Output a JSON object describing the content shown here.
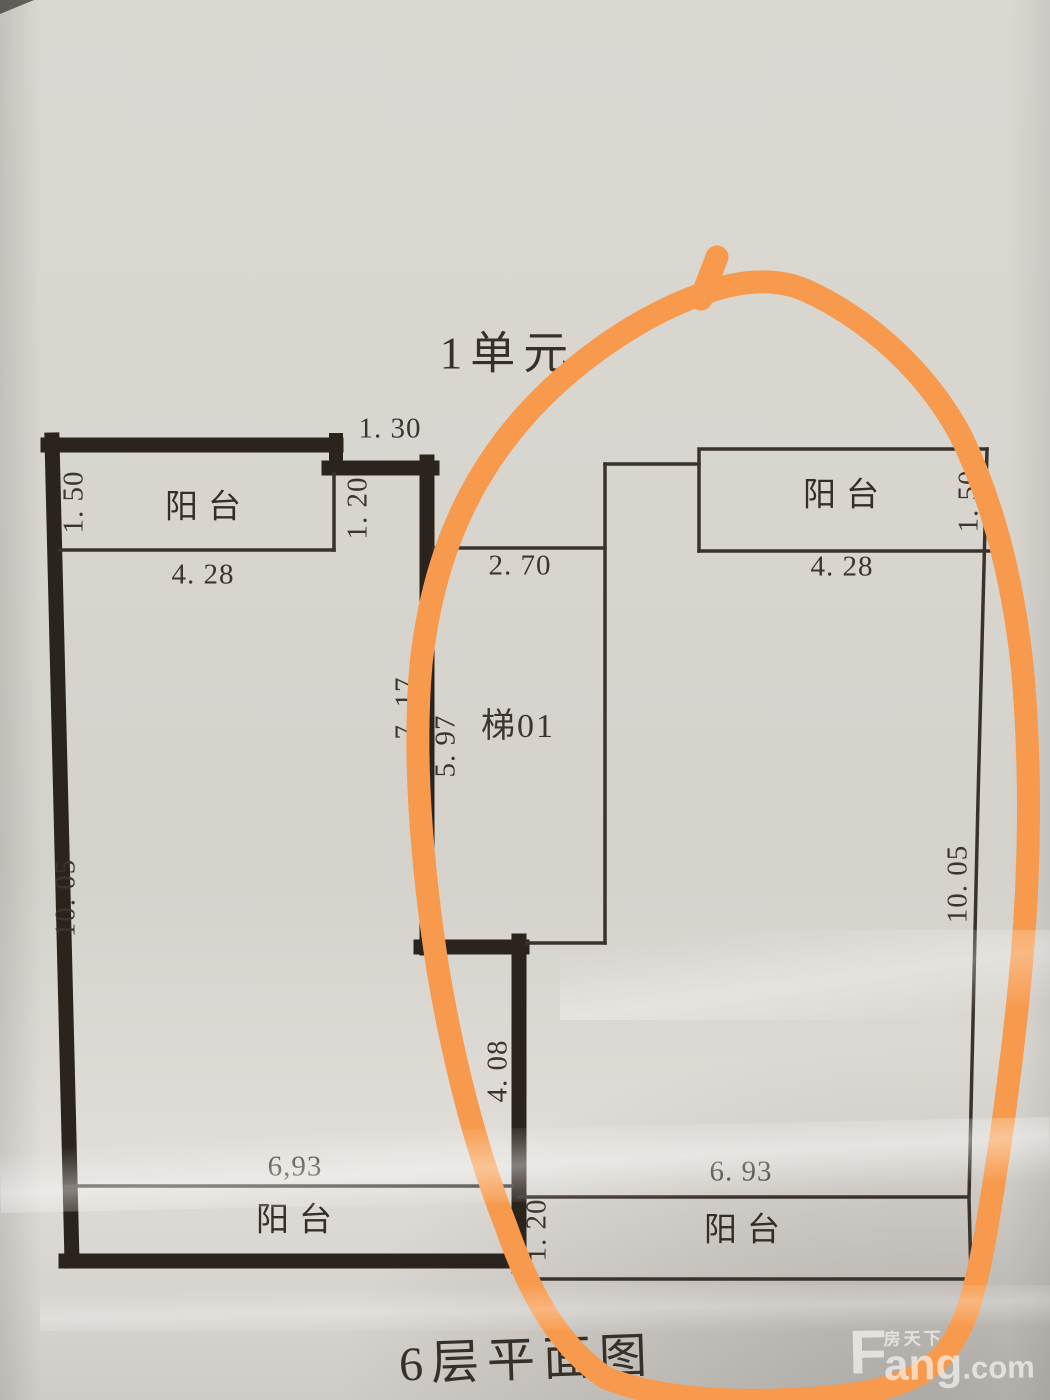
{
  "page": {
    "unit_title": "1单元",
    "floor_title": "6层平面图"
  },
  "rooms": {
    "balcony_top_left": "阳台",
    "balcony_top_right": "阳台",
    "balcony_bottom_left": "阳台",
    "balcony_bottom_right": "阳台",
    "stairwell": "梯01"
  },
  "dimensions": {
    "top_step_width": "1. 30",
    "balcony_tl_depth": "1. 50",
    "balcony_tl_width": "4. 28",
    "entry_gap_top": "1. 20",
    "stair_width": "2. 70",
    "balcony_tr_depth": "1. 50",
    "balcony_tr_width": "4. 28",
    "stair_wall_outer": "7. 17",
    "stair_wall_inner": "5. 97",
    "side_left_height": "10. 05",
    "side_right_height": "10. 05",
    "mid_wall_height": "4. 08",
    "balcony_bl_width": "6,93",
    "balcony_br_width": "6. 93",
    "entry_gap_bottom": "1. 20"
  },
  "watermark": {
    "brand_en_head": "F",
    "brand_cn": "房天下",
    "brand_en_tail": "ang",
    "brand_tld": ".com"
  },
  "annotation": {
    "type": "hand-drawn ellipse around right unit",
    "marker_color": "#f79a4d"
  },
  "colors": {
    "paper": "#d7d4ce",
    "ink": "#3c352c",
    "wall": "#2b241d",
    "marker_orange": "#f79a4d",
    "watermark_white": "rgba(255,255,255,0.62)"
  }
}
